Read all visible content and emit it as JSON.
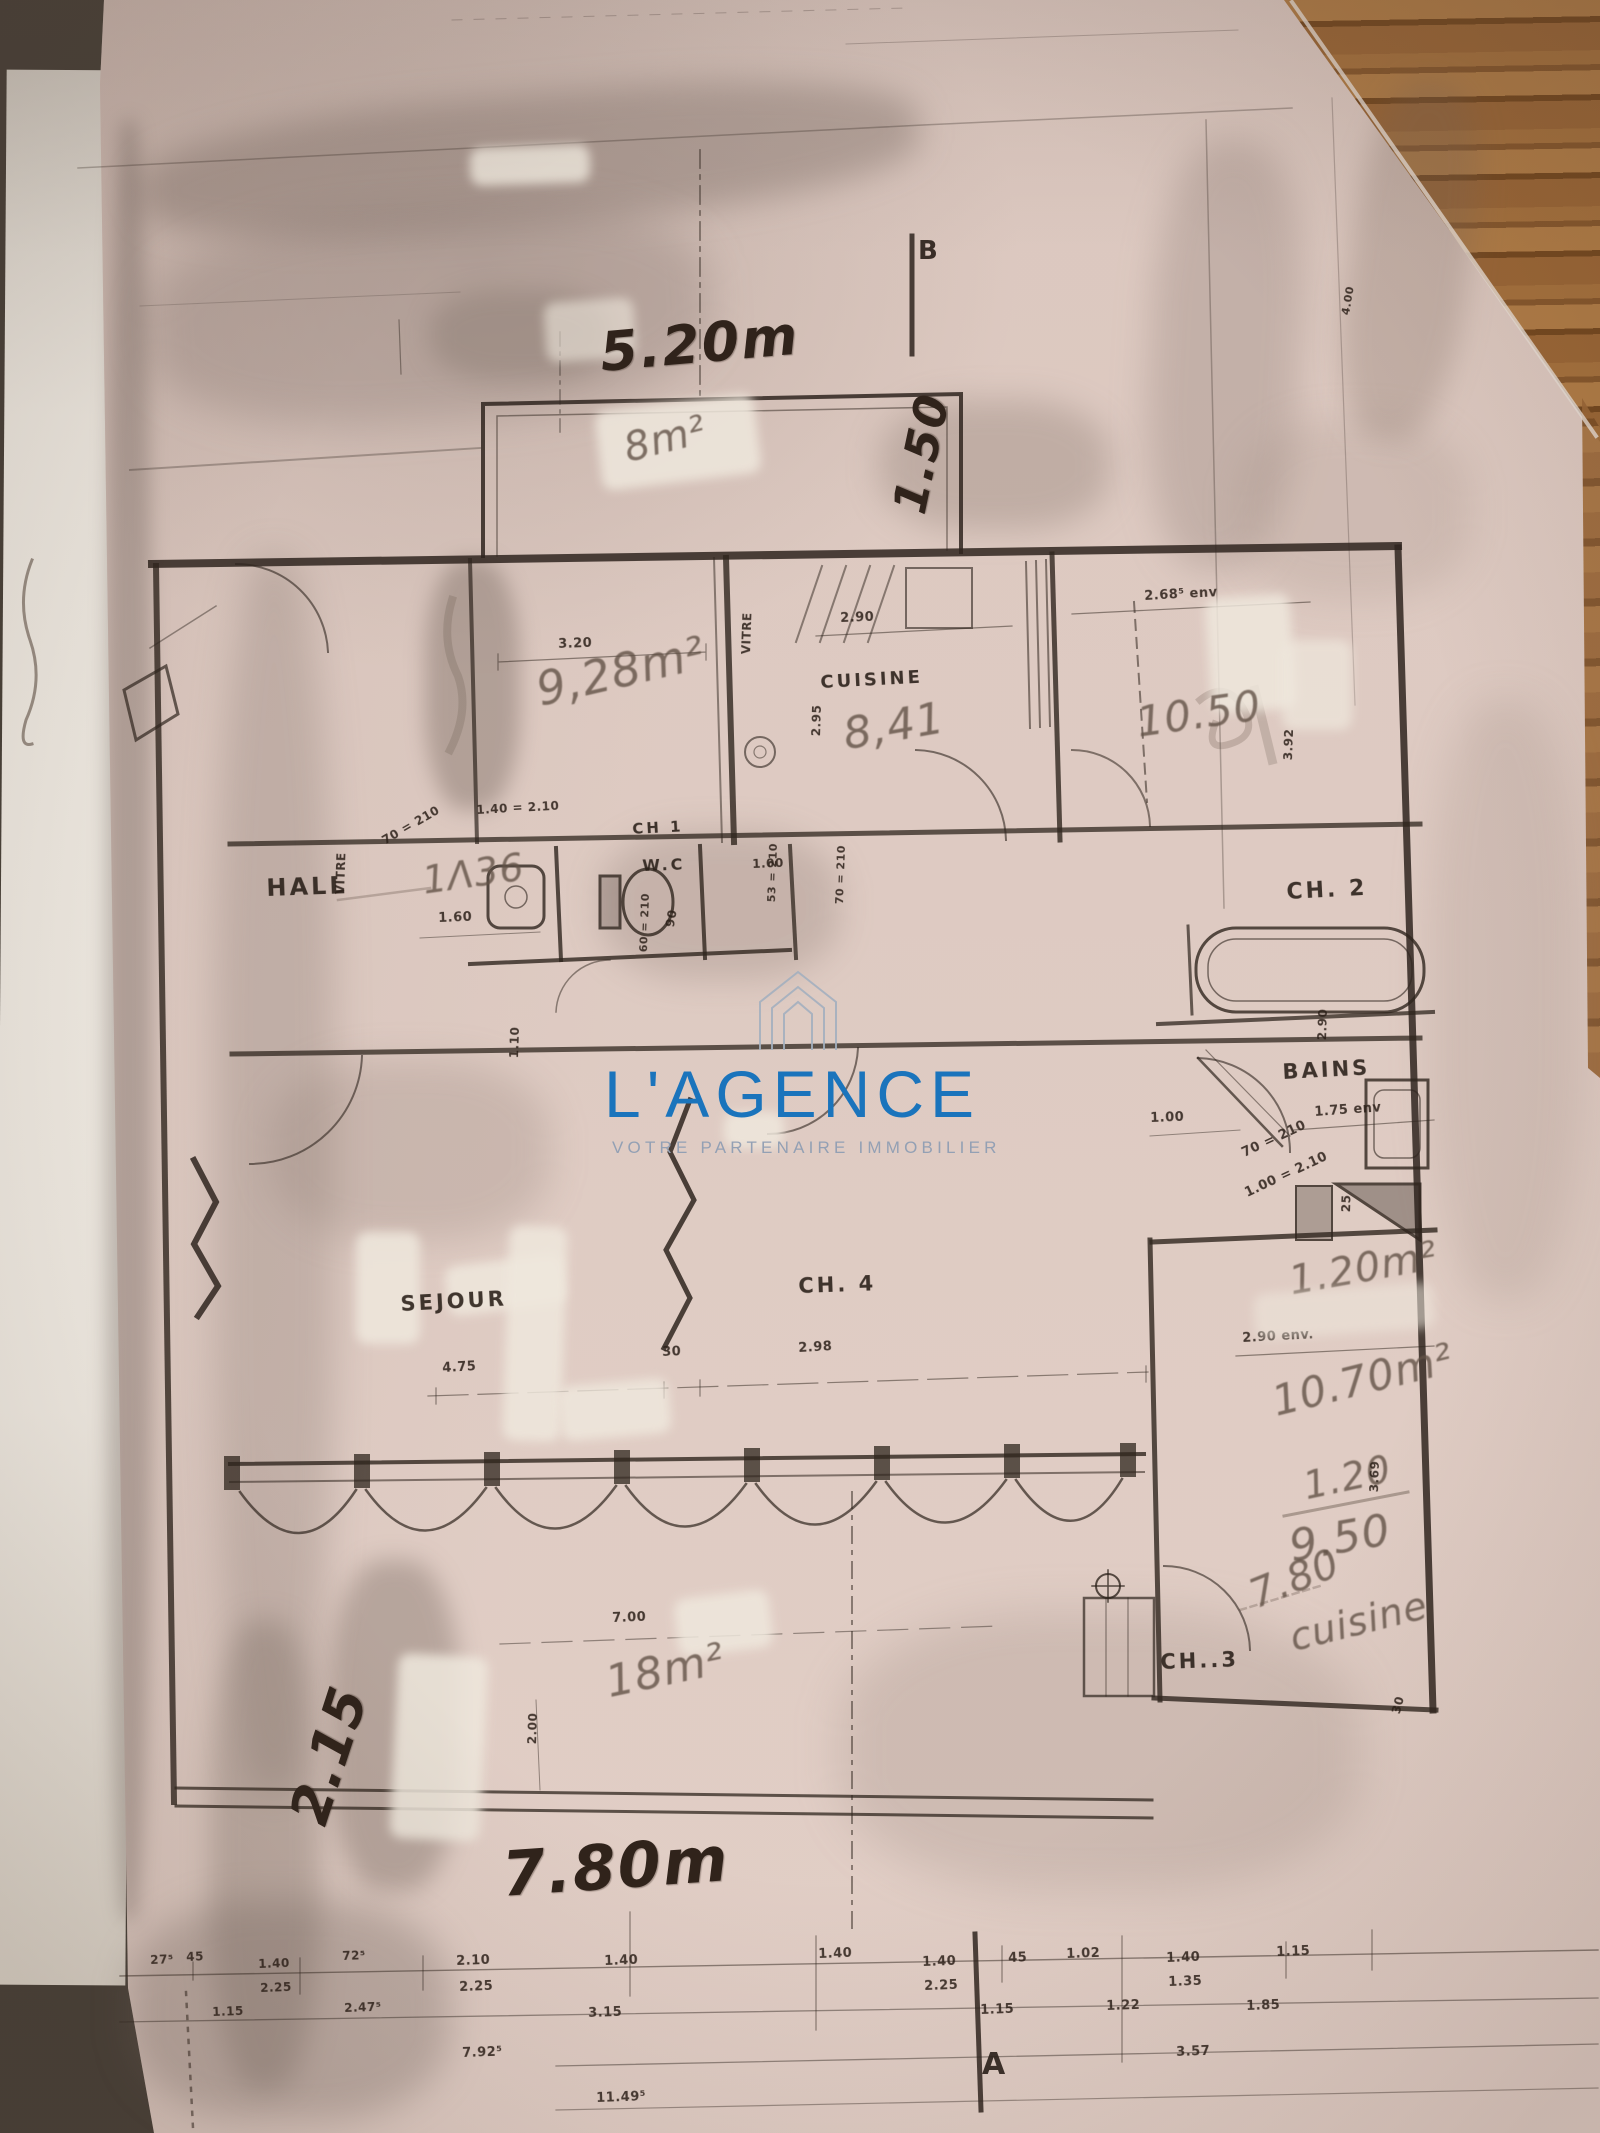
{
  "watermark": {
    "brand": "L'AGENCE",
    "tagline": "VOTRE PARTENAIRE IMMOBILIER",
    "brand_color": "#1a74bc",
    "tagline_color": "#93a0b4",
    "icon": "house-outline-icon"
  },
  "colors": {
    "paper": "#d9c5bd",
    "wood": "#96613a",
    "ink": "#2f251e",
    "pencil": "#5f4f44"
  },
  "annotations": [
    {
      "t": "5.20m",
      "x": 598,
      "y": 326,
      "r": -5,
      "s": 54,
      "ink": "marker"
    },
    {
      "t": "1.50",
      "x": 886,
      "y": 508,
      "r": -78,
      "s": 46,
      "ink": "marker"
    },
    {
      "t": "2.15",
      "x": 282,
      "y": 1814,
      "r": -72,
      "s": 54,
      "ink": "marker"
    },
    {
      "t": "7.80m",
      "x": 500,
      "y": 1844,
      "r": -4,
      "s": 62,
      "ink": "marker"
    },
    {
      "t": "8m²",
      "x": 620,
      "y": 430,
      "r": -14,
      "s": 40,
      "ink": "pencil"
    },
    {
      "t": "9,28m²",
      "x": 532,
      "y": 668,
      "r": -13,
      "s": 46,
      "ink": "pencil"
    },
    {
      "t": "8,41",
      "x": 840,
      "y": 714,
      "r": -10,
      "s": 44,
      "ink": "pencil"
    },
    {
      "t": "10.50",
      "x": 1134,
      "y": 702,
      "r": -8,
      "s": 42,
      "ink": "pencil"
    },
    {
      "t": "1Λ36",
      "x": 420,
      "y": 862,
      "r": -8,
      "s": 38,
      "ink": "pencil"
    },
    {
      "t": "1.20m²",
      "x": 1286,
      "y": 1262,
      "r": -10,
      "s": 40,
      "ink": "pencil"
    },
    {
      "t": "10.70m²",
      "x": 1268,
      "y": 1382,
      "r": -14,
      "s": 42,
      "ink": "pencil"
    },
    {
      "t": "1.20",
      "x": 1300,
      "y": 1468,
      "r": -12,
      "s": 38,
      "ink": "pencil"
    },
    {
      "t": "9.50",
      "x": 1286,
      "y": 1526,
      "r": -10,
      "s": 44,
      "ink": "pencil"
    },
    {
      "t": "7.80",
      "x": 1244,
      "y": 1578,
      "r": -22,
      "s": 40,
      "ink": "pencil"
    },
    {
      "t": "cuisine",
      "x": 1286,
      "y": 1620,
      "r": -14,
      "s": 38,
      "ink": "pencil"
    },
    {
      "t": "18m²",
      "x": 602,
      "y": 1662,
      "r": -12,
      "s": 44,
      "ink": "pencil"
    },
    {
      "t": "HALL",
      "x": 266,
      "y": 876,
      "r": -2,
      "s": 24,
      "ink": "label"
    },
    {
      "t": "CH 1",
      "x": 632,
      "y": 822,
      "r": -3,
      "s": 15,
      "ink": "label"
    },
    {
      "t": "W.C",
      "x": 642,
      "y": 858,
      "r": -2,
      "s": 16,
      "ink": "label"
    },
    {
      "t": "CUISINE",
      "x": 820,
      "y": 674,
      "r": -3,
      "s": 18,
      "ink": "label"
    },
    {
      "t": "CH. 2",
      "x": 1286,
      "y": 882,
      "r": -3,
      "s": 22,
      "ink": "label"
    },
    {
      "t": "BAINS",
      "x": 1282,
      "y": 1062,
      "r": -3,
      "s": 21,
      "ink": "label"
    },
    {
      "t": "SEJOUR",
      "x": 400,
      "y": 1294,
      "r": -3,
      "s": 21,
      "ink": "label"
    },
    {
      "t": "CH. 4",
      "x": 798,
      "y": 1276,
      "r": -2,
      "s": 21,
      "ink": "label"
    },
    {
      "t": "CH..3",
      "x": 1160,
      "y": 1652,
      "r": -2,
      "s": 21,
      "ink": "label"
    },
    {
      "t": "VITRE",
      "x": 334,
      "y": 894,
      "r": -88,
      "s": 12,
      "ink": "print"
    },
    {
      "t": "VITRE",
      "x": 740,
      "y": 654,
      "r": -88,
      "s": 12,
      "ink": "print"
    },
    {
      "t": "3.20",
      "x": 558,
      "y": 638,
      "r": -2,
      "s": 13,
      "ink": "print"
    },
    {
      "t": "2.90",
      "x": 840,
      "y": 612,
      "r": -2,
      "s": 13,
      "ink": "print"
    },
    {
      "t": "2.95",
      "x": 810,
      "y": 736,
      "r": -88,
      "s": 12,
      "ink": "print"
    },
    {
      "t": "2.68⁵ env",
      "x": 1144,
      "y": 590,
      "r": -3,
      "s": 13,
      "ink": "print"
    },
    {
      "t": "3.92",
      "x": 1282,
      "y": 760,
      "r": -88,
      "s": 12,
      "ink": "print"
    },
    {
      "t": "70 = 210",
      "x": 380,
      "y": 836,
      "r": -30,
      "s": 12,
      "ink": "print"
    },
    {
      "t": "1.40 = 2.10",
      "x": 476,
      "y": 804,
      "r": -3,
      "s": 12,
      "ink": "print"
    },
    {
      "t": "1.60",
      "x": 438,
      "y": 912,
      "r": -2,
      "s": 13,
      "ink": "print"
    },
    {
      "t": "60 = 210",
      "x": 638,
      "y": 952,
      "r": -88,
      "s": 11,
      "ink": "print"
    },
    {
      "t": "90",
      "x": 664,
      "y": 926,
      "r": -80,
      "s": 12,
      "ink": "print"
    },
    {
      "t": "1.00",
      "x": 752,
      "y": 858,
      "r": -2,
      "s": 12,
      "ink": "print"
    },
    {
      "t": "53 = 210",
      "x": 766,
      "y": 902,
      "r": -88,
      "s": 11,
      "ink": "print"
    },
    {
      "t": "70 = 210",
      "x": 834,
      "y": 904,
      "r": -88,
      "s": 11,
      "ink": "print"
    },
    {
      "t": "2.90",
      "x": 1316,
      "y": 1040,
      "r": -88,
      "s": 12,
      "ink": "print"
    },
    {
      "t": "1.00",
      "x": 1150,
      "y": 1112,
      "r": -2,
      "s": 13,
      "ink": "print"
    },
    {
      "t": "70 = 210",
      "x": 1240,
      "y": 1148,
      "r": -25,
      "s": 13,
      "ink": "print"
    },
    {
      "t": "1.00 = 2.10",
      "x": 1243,
      "y": 1188,
      "r": -25,
      "s": 13,
      "ink": "print"
    },
    {
      "t": "1.75 env",
      "x": 1314,
      "y": 1106,
      "r": -4,
      "s": 13,
      "ink": "print"
    },
    {
      "t": "25",
      "x": 1340,
      "y": 1212,
      "r": -88,
      "s": 12,
      "ink": "print"
    },
    {
      "t": "2.90 env.",
      "x": 1242,
      "y": 1332,
      "r": -3,
      "s": 13,
      "ink": "print"
    },
    {
      "t": "3.69",
      "x": 1368,
      "y": 1492,
      "r": -88,
      "s": 12,
      "ink": "print"
    },
    {
      "t": "30",
      "x": 662,
      "y": 1346,
      "r": -2,
      "s": 13,
      "ink": "print"
    },
    {
      "t": "2.98",
      "x": 798,
      "y": 1342,
      "r": -3,
      "s": 13,
      "ink": "print"
    },
    {
      "t": "4.75",
      "x": 442,
      "y": 1362,
      "r": -3,
      "s": 13,
      "ink": "print"
    },
    {
      "t": "7.00",
      "x": 612,
      "y": 1612,
      "r": -2,
      "s": 13,
      "ink": "print"
    },
    {
      "t": "2.00",
      "x": 526,
      "y": 1744,
      "r": -88,
      "s": 12,
      "ink": "print"
    },
    {
      "t": "30",
      "x": 1390,
      "y": 1712,
      "r": -75,
      "s": 12,
      "ink": "print"
    },
    {
      "t": "1.10",
      "x": 508,
      "y": 1058,
      "r": -88,
      "s": 12,
      "ink": "print"
    },
    {
      "t": "4.00",
      "x": 1340,
      "y": 314,
      "r": -80,
      "s": 11,
      "ink": "print"
    },
    {
      "t": "27⁵",
      "x": 150,
      "y": 1954,
      "r": -2,
      "s": 12,
      "ink": "print"
    },
    {
      "t": "45",
      "x": 186,
      "y": 1951,
      "r": -2,
      "s": 12,
      "ink": "print"
    },
    {
      "t": "1.40",
      "x": 258,
      "y": 1958,
      "r": -2,
      "s": 12,
      "ink": "print"
    },
    {
      "t": "2.25",
      "x": 260,
      "y": 1982,
      "r": -2,
      "s": 12,
      "ink": "print"
    },
    {
      "t": "72⁵",
      "x": 342,
      "y": 1950,
      "r": -2,
      "s": 12,
      "ink": "print"
    },
    {
      "t": "2.10",
      "x": 456,
      "y": 1955,
      "r": -2,
      "s": 13,
      "ink": "print"
    },
    {
      "t": "2.25",
      "x": 459,
      "y": 1981,
      "r": -2,
      "s": 13,
      "ink": "print"
    },
    {
      "t": "1.40",
      "x": 604,
      "y": 1955,
      "r": -2,
      "s": 13,
      "ink": "print"
    },
    {
      "t": "1.40",
      "x": 818,
      "y": 1948,
      "r": -2,
      "s": 13,
      "ink": "print"
    },
    {
      "t": "1.40",
      "x": 922,
      "y": 1956,
      "r": -2,
      "s": 13,
      "ink": "print"
    },
    {
      "t": "2.25",
      "x": 924,
      "y": 1980,
      "r": -2,
      "s": 13,
      "ink": "print"
    },
    {
      "t": "45",
      "x": 1008,
      "y": 1952,
      "r": -2,
      "s": 13,
      "ink": "print"
    },
    {
      "t": "1.02",
      "x": 1066,
      "y": 1948,
      "r": -2,
      "s": 13,
      "ink": "print"
    },
    {
      "t": "1.40",
      "x": 1166,
      "y": 1952,
      "r": -2,
      "s": 13,
      "ink": "print"
    },
    {
      "t": "1.35",
      "x": 1168,
      "y": 1976,
      "r": -2,
      "s": 13,
      "ink": "print"
    },
    {
      "t": "1.15",
      "x": 1276,
      "y": 1946,
      "r": -2,
      "s": 13,
      "ink": "print"
    },
    {
      "t": "1.15",
      "x": 212,
      "y": 2006,
      "r": -2,
      "s": 12,
      "ink": "print"
    },
    {
      "t": "2.47⁵",
      "x": 344,
      "y": 2002,
      "r": -2,
      "s": 12,
      "ink": "print"
    },
    {
      "t": "3.15",
      "x": 588,
      "y": 2007,
      "r": -2,
      "s": 13,
      "ink": "print"
    },
    {
      "t": "1.15",
      "x": 980,
      "y": 2004,
      "r": -2,
      "s": 13,
      "ink": "print"
    },
    {
      "t": "1.22",
      "x": 1106,
      "y": 2000,
      "r": -2,
      "s": 13,
      "ink": "print"
    },
    {
      "t": "1.85",
      "x": 1246,
      "y": 2000,
      "r": -2,
      "s": 13,
      "ink": "print"
    },
    {
      "t": "7.92⁵",
      "x": 462,
      "y": 2047,
      "r": -2,
      "s": 13,
      "ink": "print"
    },
    {
      "t": "3.57",
      "x": 1176,
      "y": 2046,
      "r": -2,
      "s": 13,
      "ink": "print"
    },
    {
      "t": "11.49⁵",
      "x": 596,
      "y": 2092,
      "r": -2,
      "s": 13,
      "ink": "print"
    },
    {
      "t": "B",
      "x": 918,
      "y": 238,
      "r": 0,
      "s": 26,
      "ink": "axis"
    },
    {
      "t": "A",
      "x": 982,
      "y": 2050,
      "r": 0,
      "s": 30,
      "ink": "axis"
    }
  ]
}
